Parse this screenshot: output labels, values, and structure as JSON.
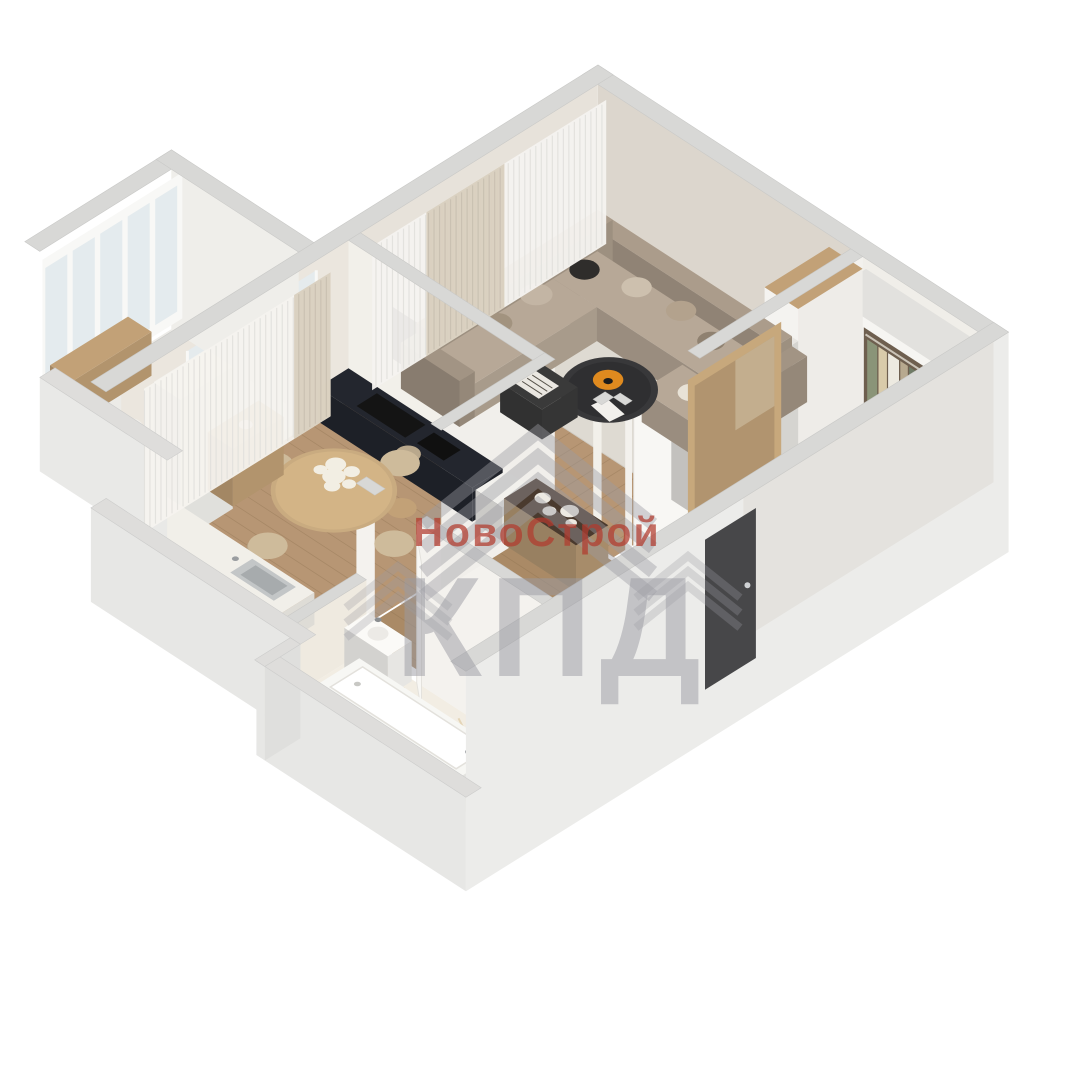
{
  "page": {
    "description": "3D axonometric cutaway render of a one-room apartment floor plan on white background",
    "background": "#ffffff"
  },
  "watermark": {
    "brand": "НовоСтрой",
    "acronym": "КПД",
    "logo_icon": "nested-chevron-roof",
    "brand_color": "#b23b2e",
    "acronym_color": "#9b9ba3"
  },
  "palette": {
    "wall_cap": "#d8d8d6",
    "wall_cap_low": "#dedddb",
    "wall_outer": "#ececea",
    "wall_inner": "#f2f0ea",
    "wall_beige": "#dcd6cd",
    "wood_floor": "#b79674",
    "wood_floor_dark": "#aa8a66",
    "plank_line": "#8a6f4e",
    "rug": "#dedad2",
    "balcony_floor": "#ecebe7",
    "sofa_body": "#ab9c8b",
    "sofa_seat": "#b7a897",
    "pillow_dark": "#2f2d2b",
    "coffee_table": "#38383a",
    "ottoman": "#3a3a3a",
    "accent_orange": "#df8a1f",
    "navy_cabinet": "#23262e",
    "appliance_black": "#141414",
    "wood_furniture": "#c2a177",
    "table_wood": "#c9ab80",
    "chair_beige": "#cebb9b",
    "marble": "#f2ede3",
    "marble_vein": "#d8c193",
    "tub_white": "#f7f7f4",
    "glass": "#e4ebee",
    "frame_white": "#f8f8f6",
    "curtain_sheer": "#f5f3ef",
    "curtain_drape": "#d9d0bf",
    "mirror_frame": "#c7a87c",
    "mirror_glass": "#b1946f",
    "door_dark": "#474749",
    "white_furniture": "#f5f4f0",
    "flower_white": "#f2eee3",
    "clothes": [
      "#8a9478",
      "#d9cbaa",
      "#edeae1",
      "#b7a98f",
      "#6f7b66",
      "#c9bfa8",
      "#a0866a"
    ]
  },
  "scene": {
    "rooms": [
      {
        "name": "living-room",
        "features": [
          "corner-sofa",
          "coffee-table",
          "ottoman",
          "rug",
          "shelving-unit",
          "curtains"
        ]
      },
      {
        "name": "kitchen-dining-room",
        "features": [
          "round-dining-table",
          "four-chairs",
          "flower-centerpiece",
          "navy-cabinet-run",
          "white-counter-with-sink",
          "tall-cabinet",
          "sideboard"
        ]
      },
      {
        "name": "hallway",
        "features": [
          "open-wardrobe-with-clothes",
          "leaning-mirror",
          "bench-with-vases",
          "entry-door"
        ]
      },
      {
        "name": "bathroom",
        "features": [
          "marble-floor",
          "bathtub",
          "washbasin"
        ]
      },
      {
        "name": "balcony",
        "features": [
          "window-band",
          "wood-console"
        ]
      },
      {
        "name": "corridor",
        "features": [
          "console-with-orchid"
        ]
      }
    ]
  }
}
